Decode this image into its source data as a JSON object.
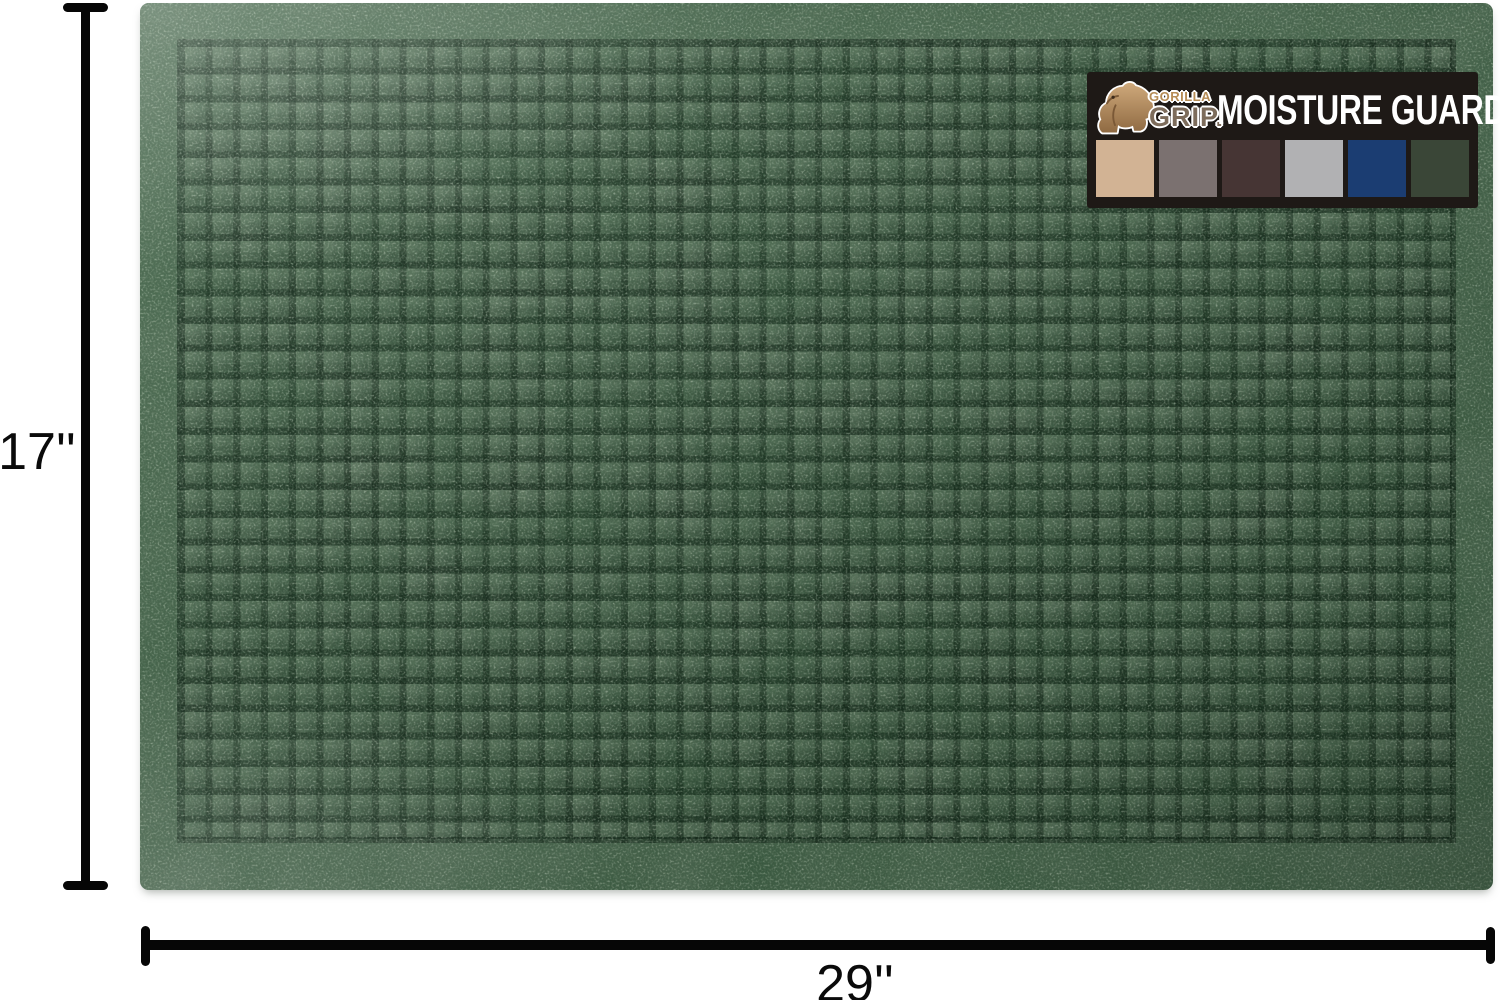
{
  "page": {
    "background_color": "#ffffff"
  },
  "product": {
    "type": "door mat",
    "mat_color_name": "green",
    "mat_base_color": "#516e55",
    "mat_groove_color": "#1f3626",
    "texture": "waffle-square-grid"
  },
  "dimensions": {
    "height_label": "17''",
    "width_label": "29''",
    "line_color": "#060606"
  },
  "badge": {
    "background_color": "#1e1916",
    "title": "MOISTURE GUARD",
    "title_color": "#ffffff",
    "logo": {
      "line1": "GORILLA",
      "line2": "GRIP."
    },
    "swatches": [
      {
        "name": "beige",
        "color": "#d2b394",
        "style": "background:#d2b394"
      },
      {
        "name": "taupe-gray",
        "color": "#7b7170",
        "style": "background:#7b7170"
      },
      {
        "name": "dark-brown",
        "color": "#463534",
        "style": "background:#463534"
      },
      {
        "name": "light-gray",
        "color": "#b1b1b3",
        "style": "background:#b1b1b3"
      },
      {
        "name": "navy-blue",
        "color": "#1b3d72",
        "style": "background:#1b3d72"
      },
      {
        "name": "dark-green",
        "color": "#3a4637",
        "style": "background:#3a4637"
      }
    ]
  }
}
